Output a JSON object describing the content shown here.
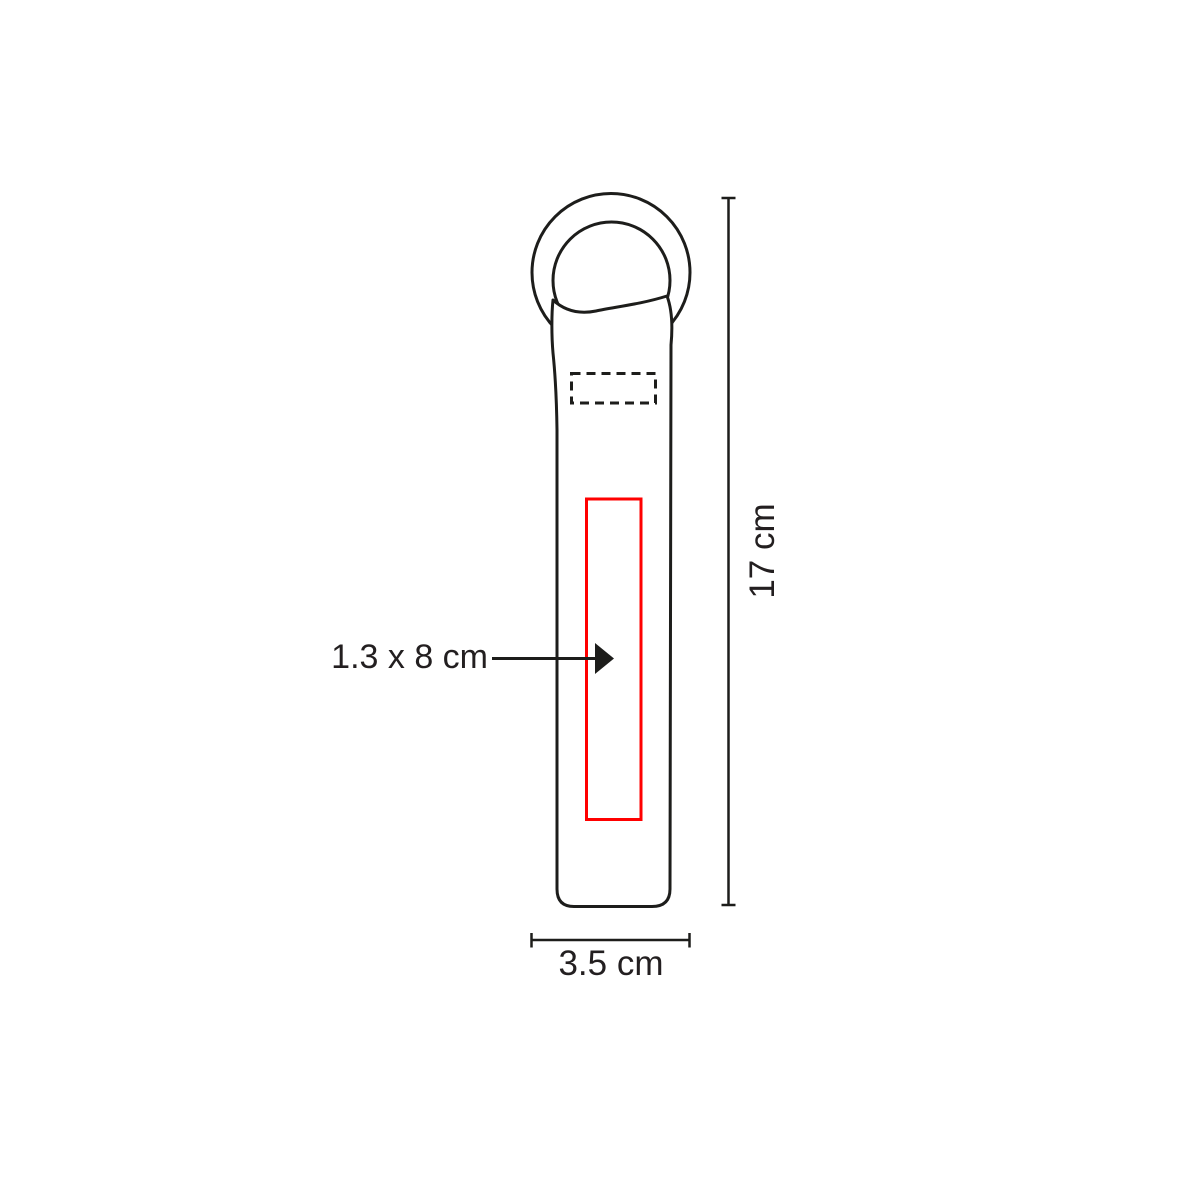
{
  "diagram": {
    "labels": {
      "imprint_size": "1.3 x 8 cm",
      "height": "17 cm",
      "width": "3.5 cm"
    }
  },
  "colors": {
    "line": "#1d1d1b",
    "imprint_red": "#ff0000",
    "background": "#ffffff",
    "text": "#231f20"
  }
}
